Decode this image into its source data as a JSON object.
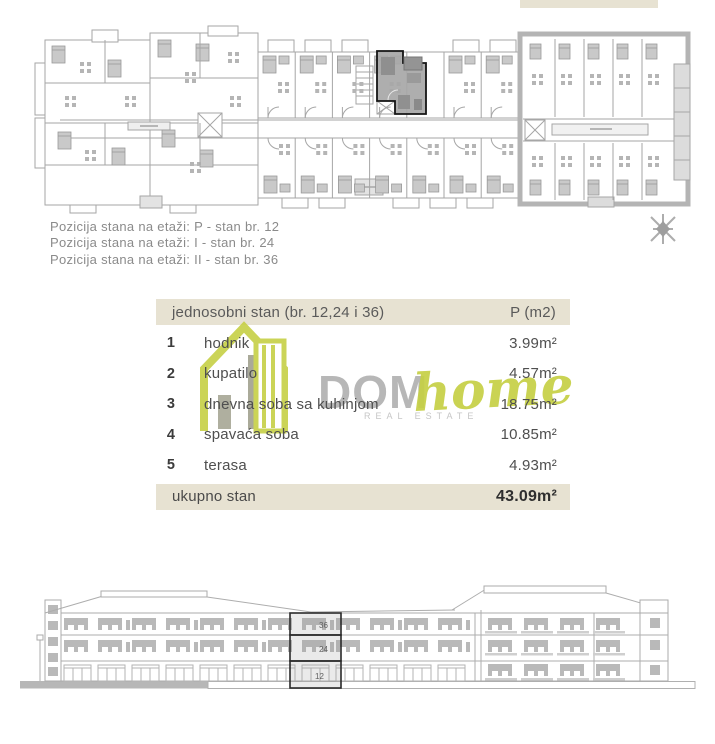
{
  "position_info": {
    "lines": [
      "Pozicija stana na etaži: P - stan br. 12",
      "Pozicija stana na etaži: I - stan br. 24",
      "Pozicija stana na etaži: II - stan br. 36"
    ]
  },
  "table": {
    "header": {
      "label": "jednosobni stan (br. 12,24 i 36)",
      "area_label": "P (m2)"
    },
    "rows": [
      {
        "num": "1",
        "label": "hodnik",
        "value": "3.99m²"
      },
      {
        "num": "2",
        "label": "kupatilo",
        "value": "4.57m²"
      },
      {
        "num": "3",
        "label": "dnevna soba sa kuhinjom",
        "value": "18.75m²"
      },
      {
        "num": "4",
        "label": "spavaća soba",
        "value": "10.85m²"
      },
      {
        "num": "5",
        "label": "terasa",
        "value": "4.93m²"
      }
    ],
    "total": {
      "label": "ukupno stan",
      "value": "43.09m²"
    }
  },
  "logo": {
    "dom": "DOM",
    "home": "home",
    "tagline": "REAL ESTATE"
  },
  "elevation": {
    "floors": [
      {
        "label": "36"
      },
      {
        "label": "24"
      },
      {
        "label": "12"
      }
    ]
  },
  "colors": {
    "beige": "#e7e2d2",
    "accent_green": "#c6d045",
    "plan_gray": "#a6a6a6",
    "highlight_fill": "#a7a7a7",
    "highlight_outline": "#141414",
    "text_gray": "#8b8b8b",
    "text_dark": "#4f4f4f"
  }
}
